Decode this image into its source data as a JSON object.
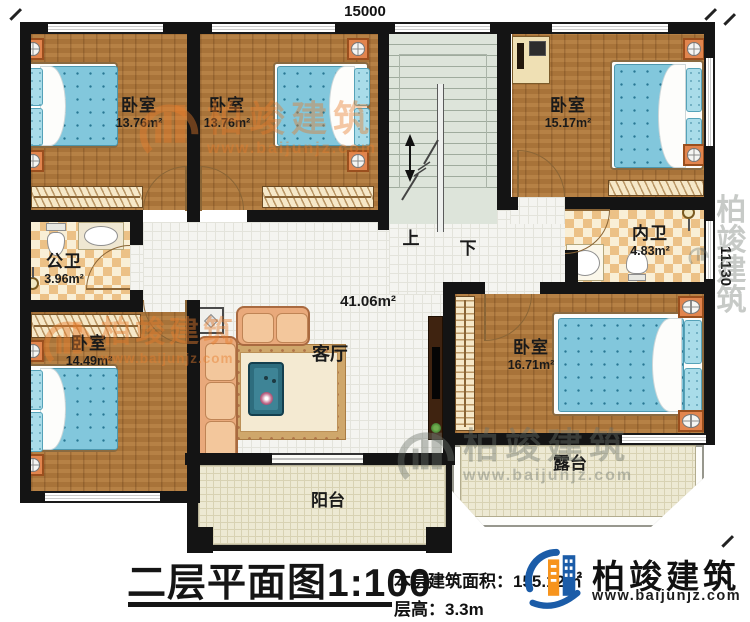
{
  "dimensions": {
    "top": "15000",
    "right": "11130"
  },
  "rooms": {
    "bedroom_top_left": {
      "name": "卧室",
      "area": "13.76m²"
    },
    "bedroom_top_mid": {
      "name": "卧室",
      "area": "13.76m²"
    },
    "bedroom_top_right": {
      "name": "卧室",
      "area": "15.17m²"
    },
    "public_bath": {
      "name": "公卫",
      "area": "3.96m²"
    },
    "ensuite_bath": {
      "name": "内卫",
      "area": "4.83m²"
    },
    "bedroom_bottom_left": {
      "name": "卧室",
      "area": "14.49m²"
    },
    "living_room": {
      "name": "客厅",
      "area": "41.06m²"
    },
    "bedroom_bottom_right": {
      "name": "卧室",
      "area": "16.71m²"
    },
    "balcony": {
      "name": "阳台"
    },
    "terrace": {
      "name": "露台"
    }
  },
  "stairs": {
    "up": "上",
    "down": "下"
  },
  "watermark": {
    "brand": "柏竣建筑",
    "url": "www.baijunjz.com"
  },
  "title_block": {
    "plan_title": "二层平面图1:100",
    "area_label": "本层建筑面积：",
    "area_value": "155.12㎡",
    "height_label": "层高：",
    "height_value": "3.3m"
  },
  "logo": {
    "brand": "柏竣建筑",
    "url": "www.baijunjz.com"
  },
  "colors": {
    "wall": "#141414",
    "wood_floor": "#b1793c",
    "tile": "#f4f4f0",
    "stairs": "#dde4da",
    "checker": "#ecc186",
    "bed_blue": "#82c7dc",
    "accent_orange": "#e2854e",
    "logo_blue": "#1b5ca8",
    "logo_orange": "#f7941d"
  }
}
